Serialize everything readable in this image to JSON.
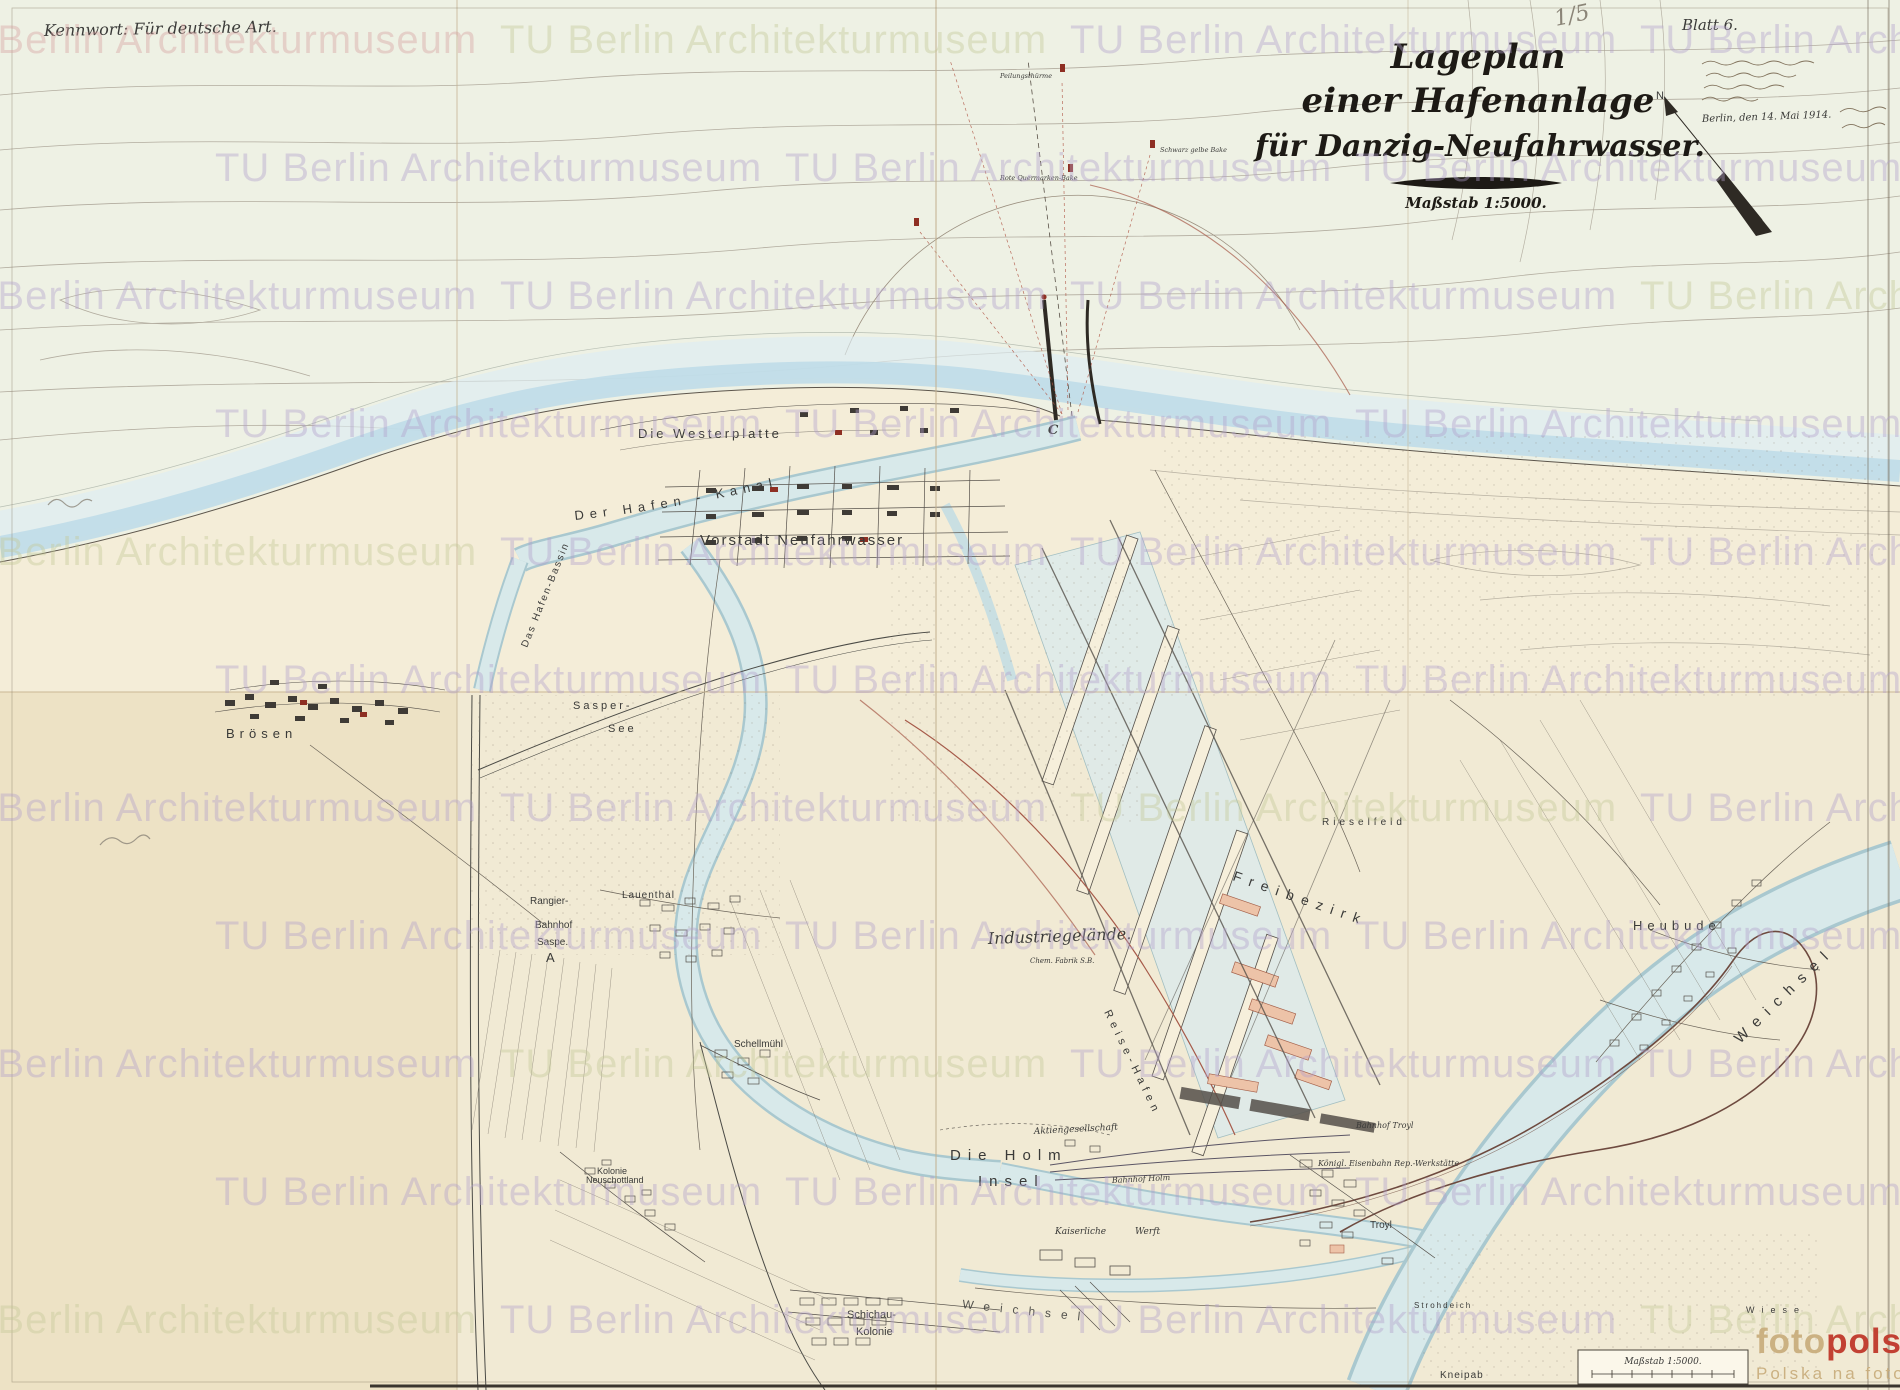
{
  "header": {
    "kennwort": "Kennwort: Für deutsche Art.",
    "sheet_number": "Blatt 6.",
    "pencil_number": "1/5"
  },
  "cartouche": {
    "title_line1": "Lageplan",
    "title_line2": "einer Hafenanlage",
    "title_line3": "für Danzig-Neufahrwasser.",
    "scale_note": "Maßstab 1:5000."
  },
  "compass": {
    "north_label": "N."
  },
  "handwriting": {
    "date_line": "Berlin, den 14. Mai 1914."
  },
  "scale_box": {
    "label": "Maßstab 1:5000."
  },
  "map_labels": {
    "westerplatte": "Die Westerplatte",
    "hafen_kanal": "Der Hafen - Kanal",
    "hafen_bassin": "Das Hafen-Bassin",
    "vorstadt": "Vorstadt Neufahrwasser",
    "broesen": "Brösen",
    "sasper_see_1": "Sasper-",
    "sasper_see_2": "See",
    "rangier_1": "Rangier-",
    "rangier_2": "Bahnhof",
    "rangier_3": "Saspe.",
    "rangier_4": "A",
    "lauenthal": "Lauenthal",
    "schellmuehl": "Schellmühl",
    "kolonie_1": "Kolonie",
    "kolonie_2": "Neuschottland",
    "industriegelaende": "Industriegelände.",
    "freibezirk": "Freibezirk",
    "rieselfeld": "Rieselfeld",
    "reisehafen": "Reise-Hafen",
    "heubude": "Heubude",
    "weichsel": "Weichsel",
    "weichsel_bottom": "Weichsel",
    "holm_1": "Die Holm",
    "holm_2": "Insel",
    "kaiserliche_werft": "Kaiserliche Werft",
    "bahnhof_holm": "Bahnhof Holm",
    "aktiengesellschaft": "Aktiengesellschaft",
    "chem_fabrik": "Chem. Fabrik S.B.",
    "troyl": "Troyl",
    "bahnhof_troyl": "Bahnhof Troyl",
    "eisenbahn_werkstaette": "Königl. Eisenbahn Rep.-Werkstätte",
    "schichau_1": "Schichau-",
    "schichau_2": "Kolonie",
    "strohdeich": "Strohdeich",
    "kneipab": "Kneipab",
    "wiese": "Wiese",
    "marker_c": "C",
    "sea_label_1": "Peilungsthürme",
    "sea_label_2": "Rote Quermarken-Bake",
    "sea_label_3": "Schwarz gelbe Bake"
  },
  "archive_watermark": {
    "text": "TU Berlin Architekturmuseum"
  },
  "fotopolska": {
    "brand_foto": "foto",
    "brand_polska": "polska",
    "brand_tld": ".eu",
    "tagline": "Polska na fotografii"
  },
  "palette": {
    "paper": "#f4edd8",
    "sea_paper": "#eef1e4",
    "water_fill": "#d8e9ea",
    "water_edge": "#a9c8cf",
    "ink": "#3a3a38",
    "red_accent": "#8e2f23",
    "salmon": "#edc3a8",
    "watermark_lavender": "#b2a0cc",
    "watermark_green": "#c3c896",
    "fotopolska_beige": "#c9ae7e",
    "fotopolska_red": "#c0392b"
  }
}
